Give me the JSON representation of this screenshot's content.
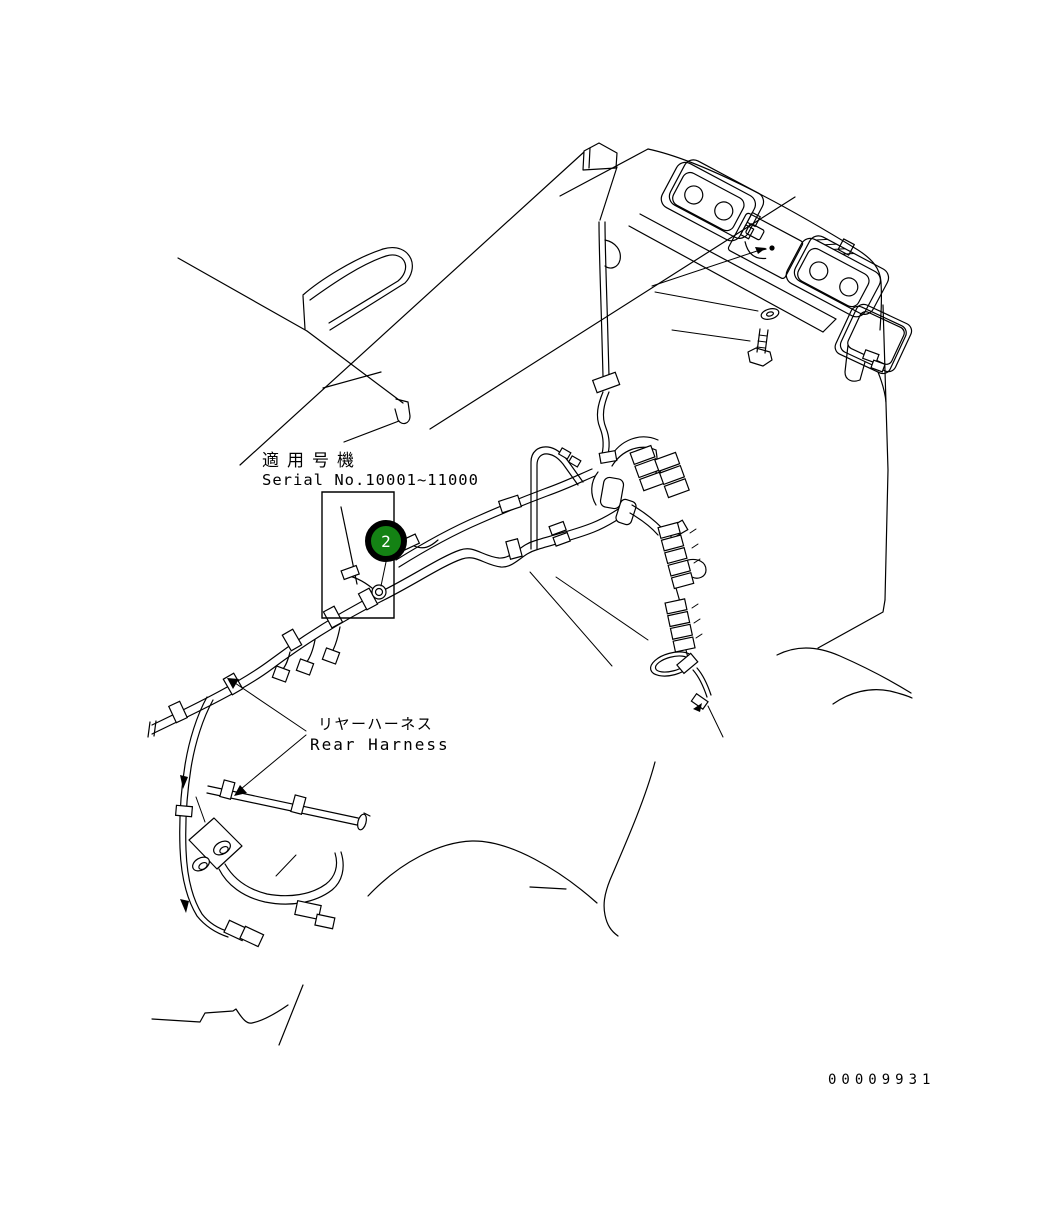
{
  "figure": {
    "type": "parts-diagram",
    "subject": "rear-harness-on-cab-roof",
    "title_block": {
      "applicable_label_jp": "適用号機",
      "serial_range": "Serial No.10001~11000"
    },
    "part_label": {
      "jp": "リヤーハーネス",
      "en": "Rear Harness"
    },
    "callout": {
      "number": "2"
    },
    "drawing_number": "00009931",
    "colors": {
      "line": "#000000",
      "background": "#ffffff",
      "callout_fill": "#148214",
      "callout_ring": "#000000",
      "callout_text": "#ffffff"
    }
  }
}
